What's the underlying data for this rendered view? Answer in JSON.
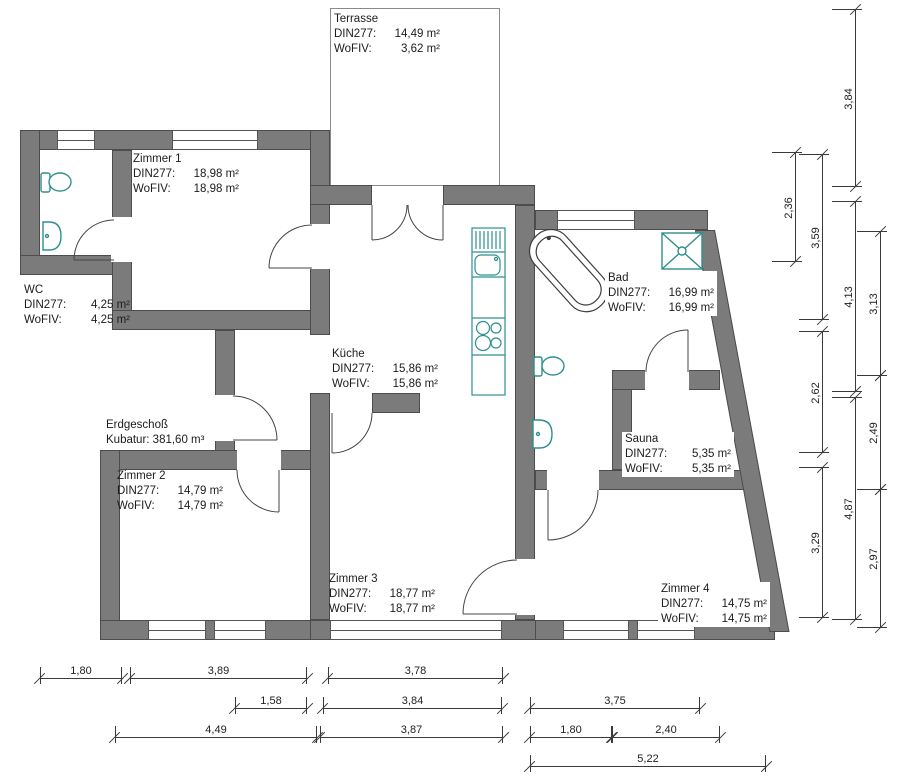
{
  "floor": {
    "name": "Erdgeschoß",
    "kubatur": "Kubatur: 381,60 m³"
  },
  "rooms": [
    {
      "id": "terrasse",
      "name": "Terrasse",
      "din_key": "DIN277:",
      "din_value": "14,49 m²",
      "wofiv_key": "WoFIV:",
      "wofiv_value": "3,62 m²"
    },
    {
      "id": "zimmer1",
      "name": "Zimmer 1",
      "din_key": "DIN277:",
      "din_value": "18,98 m²",
      "wofiv_key": "WoFIV:",
      "wofiv_value": "18,98 m²"
    },
    {
      "id": "wc",
      "name": "WC",
      "din_key": "DIN277:",
      "din_value": "4,25 m²",
      "wofiv_key": "WoFIV:",
      "wofiv_value": "4,25 m²"
    },
    {
      "id": "kueche",
      "name": "Küche",
      "din_key": "DIN277:",
      "din_value": "15,86 m²",
      "wofiv_key": "WoFIV:",
      "wofiv_value": "15,86 m²"
    },
    {
      "id": "bad",
      "name": "Bad",
      "din_key": "DIN277:",
      "din_value": "16,99 m²",
      "wofiv_key": "WoFIV:",
      "wofiv_value": "16,99 m²"
    },
    {
      "id": "zimmer2",
      "name": "Zimmer 2",
      "din_key": "DIN277:",
      "din_value": "14,79 m²",
      "wofiv_key": "WoFIV:",
      "wofiv_value": "14,79 m²"
    },
    {
      "id": "sauna",
      "name": "Sauna",
      "din_key": "DIN277:",
      "din_value": "5,35 m²",
      "wofiv_key": "WoFIV:",
      "wofiv_value": "5,35 m²"
    },
    {
      "id": "zimmer3",
      "name": "Zimmer 3",
      "din_key": "DIN277:",
      "din_value": "18,77 m²",
      "wofiv_key": "WoFIV:",
      "wofiv_value": "18,77 m²"
    },
    {
      "id": "zimmer4",
      "name": "Zimmer 4",
      "din_key": "DIN277:",
      "din_value": "14,75 m²",
      "wofiv_key": "WoFIV:",
      "wofiv_value": "14,75 m²"
    }
  ],
  "dims": {
    "vertical": [
      {
        "label": "3,84"
      },
      {
        "label": "4,13"
      },
      {
        "label": "4,87"
      },
      {
        "label": "2,36"
      },
      {
        "label": "3,59"
      },
      {
        "label": "2,62"
      },
      {
        "label": "3,29"
      },
      {
        "label": "3,13"
      },
      {
        "label": "2,49"
      },
      {
        "label": "2,97"
      }
    ],
    "horizontal": [
      {
        "label": "1,80"
      },
      {
        "label": "3,89"
      },
      {
        "label": "3,78"
      },
      {
        "label": "1,58"
      },
      {
        "label": "3,84"
      },
      {
        "label": "3,75"
      },
      {
        "label": "4,49"
      },
      {
        "label": "3,87"
      },
      {
        "label": "1,80"
      },
      {
        "label": "2,40"
      },
      {
        "label": "5,22"
      }
    ]
  },
  "fixtures": [
    "toilet-icon",
    "sink-icon",
    "bathtub-icon",
    "shower-icon",
    "kitchen-sink-icon",
    "stove-icon",
    "dish-rack-icon"
  ],
  "colors": {
    "wall": "#7b7b7b",
    "wall_outline": "#4c4c4c",
    "fixture": "#2e8f8f",
    "dim_line": "#3a3a3a"
  }
}
